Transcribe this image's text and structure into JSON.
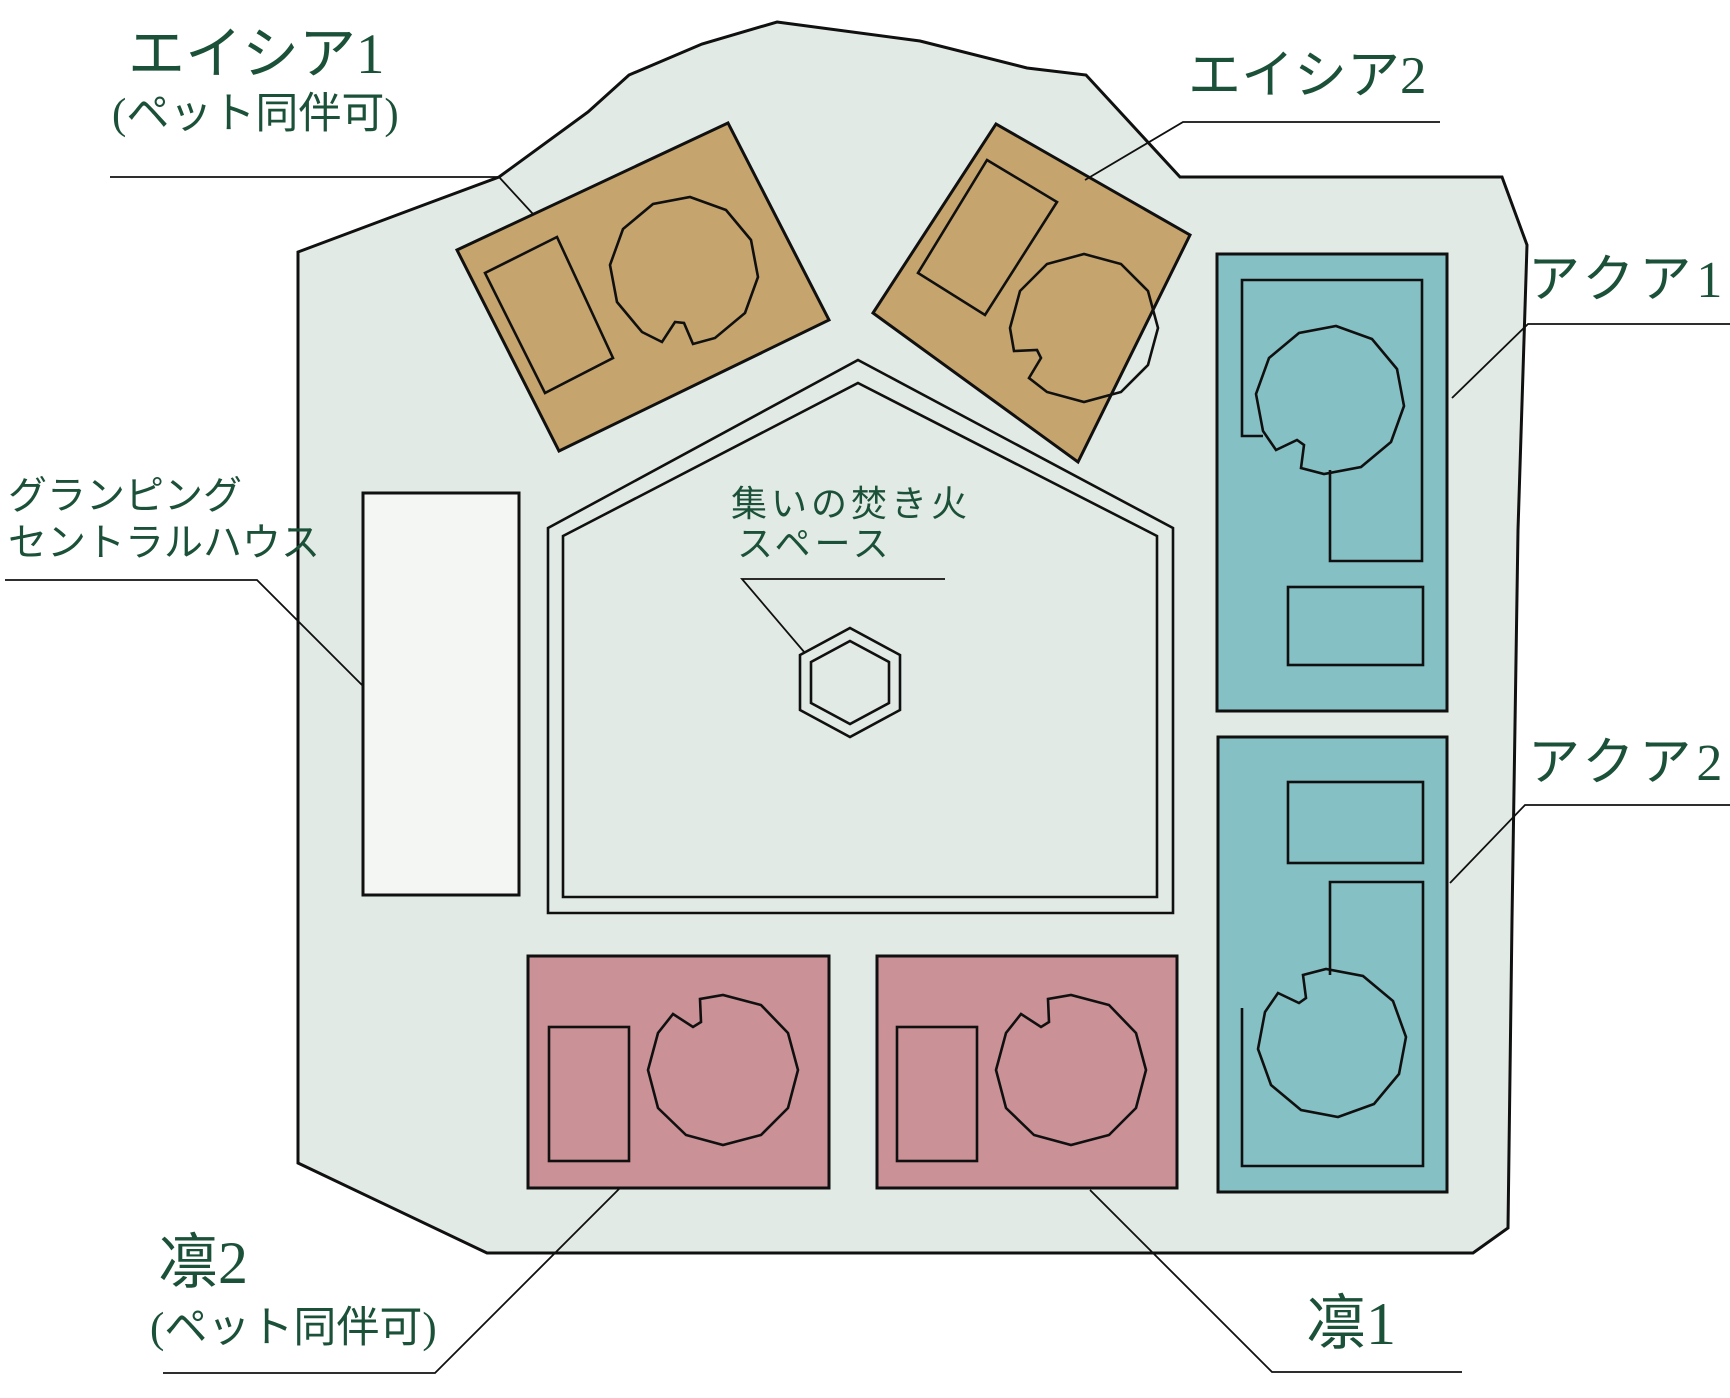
{
  "map": {
    "background": "#ffffff",
    "site_fill": "#e2eae5",
    "outline_color": "#101010",
    "text_color": "#1c5139",
    "areas": {
      "acacia1": {
        "label": "エイシア1",
        "note": "(ペット同伴可)",
        "color": "#c6a46d"
      },
      "acacia2": {
        "label": "エイシア2",
        "color": "#c6a46d"
      },
      "aqua1": {
        "label": "アクア1",
        "color": "#85c0c4"
      },
      "aqua2": {
        "label": "アクア2",
        "color": "#85c0c4"
      },
      "rin1": {
        "label": "凛1",
        "color": "#ca9196"
      },
      "rin2": {
        "label": "凛2",
        "note": "(ペット同伴可)",
        "color": "#ca9196"
      },
      "central_house": {
        "label_line1": "グランピング",
        "label_line2": "セントラルハウス",
        "color": "#f3f6f3"
      },
      "fire_space": {
        "label_line1": "集いの焚き火",
        "label_line2": "スペース"
      }
    }
  }
}
